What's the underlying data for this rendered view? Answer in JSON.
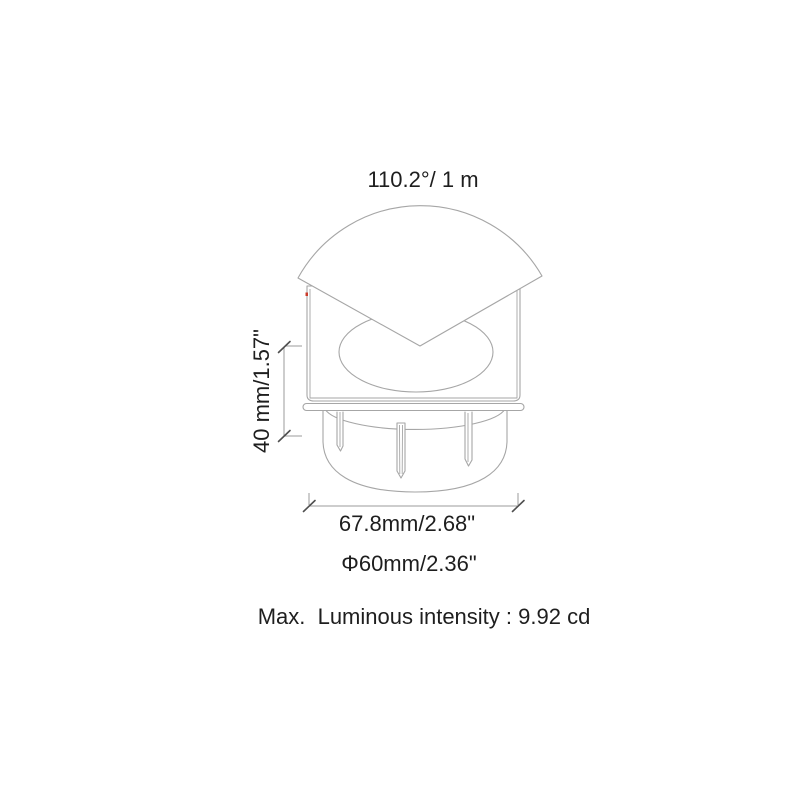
{
  "drawing": {
    "beam_angle_label": "110.2°/ 1 m",
    "height_dim_label": "40 mm/1.57\"",
    "width_dim_label": "67.8mm/2.68\"",
    "diameter_dim_label": "Φ60mm/2.36\"",
    "intensity_label": "Max.  Luminous intensity : 9.92 cd"
  },
  "colors": {
    "background": "#ffffff",
    "line": "#a6a6a6",
    "dim_line": "#9b9b9b",
    "tick": "#4f4f4f",
    "text": "#1e1e1e",
    "accent_dot": "#cc3b2a"
  }
}
